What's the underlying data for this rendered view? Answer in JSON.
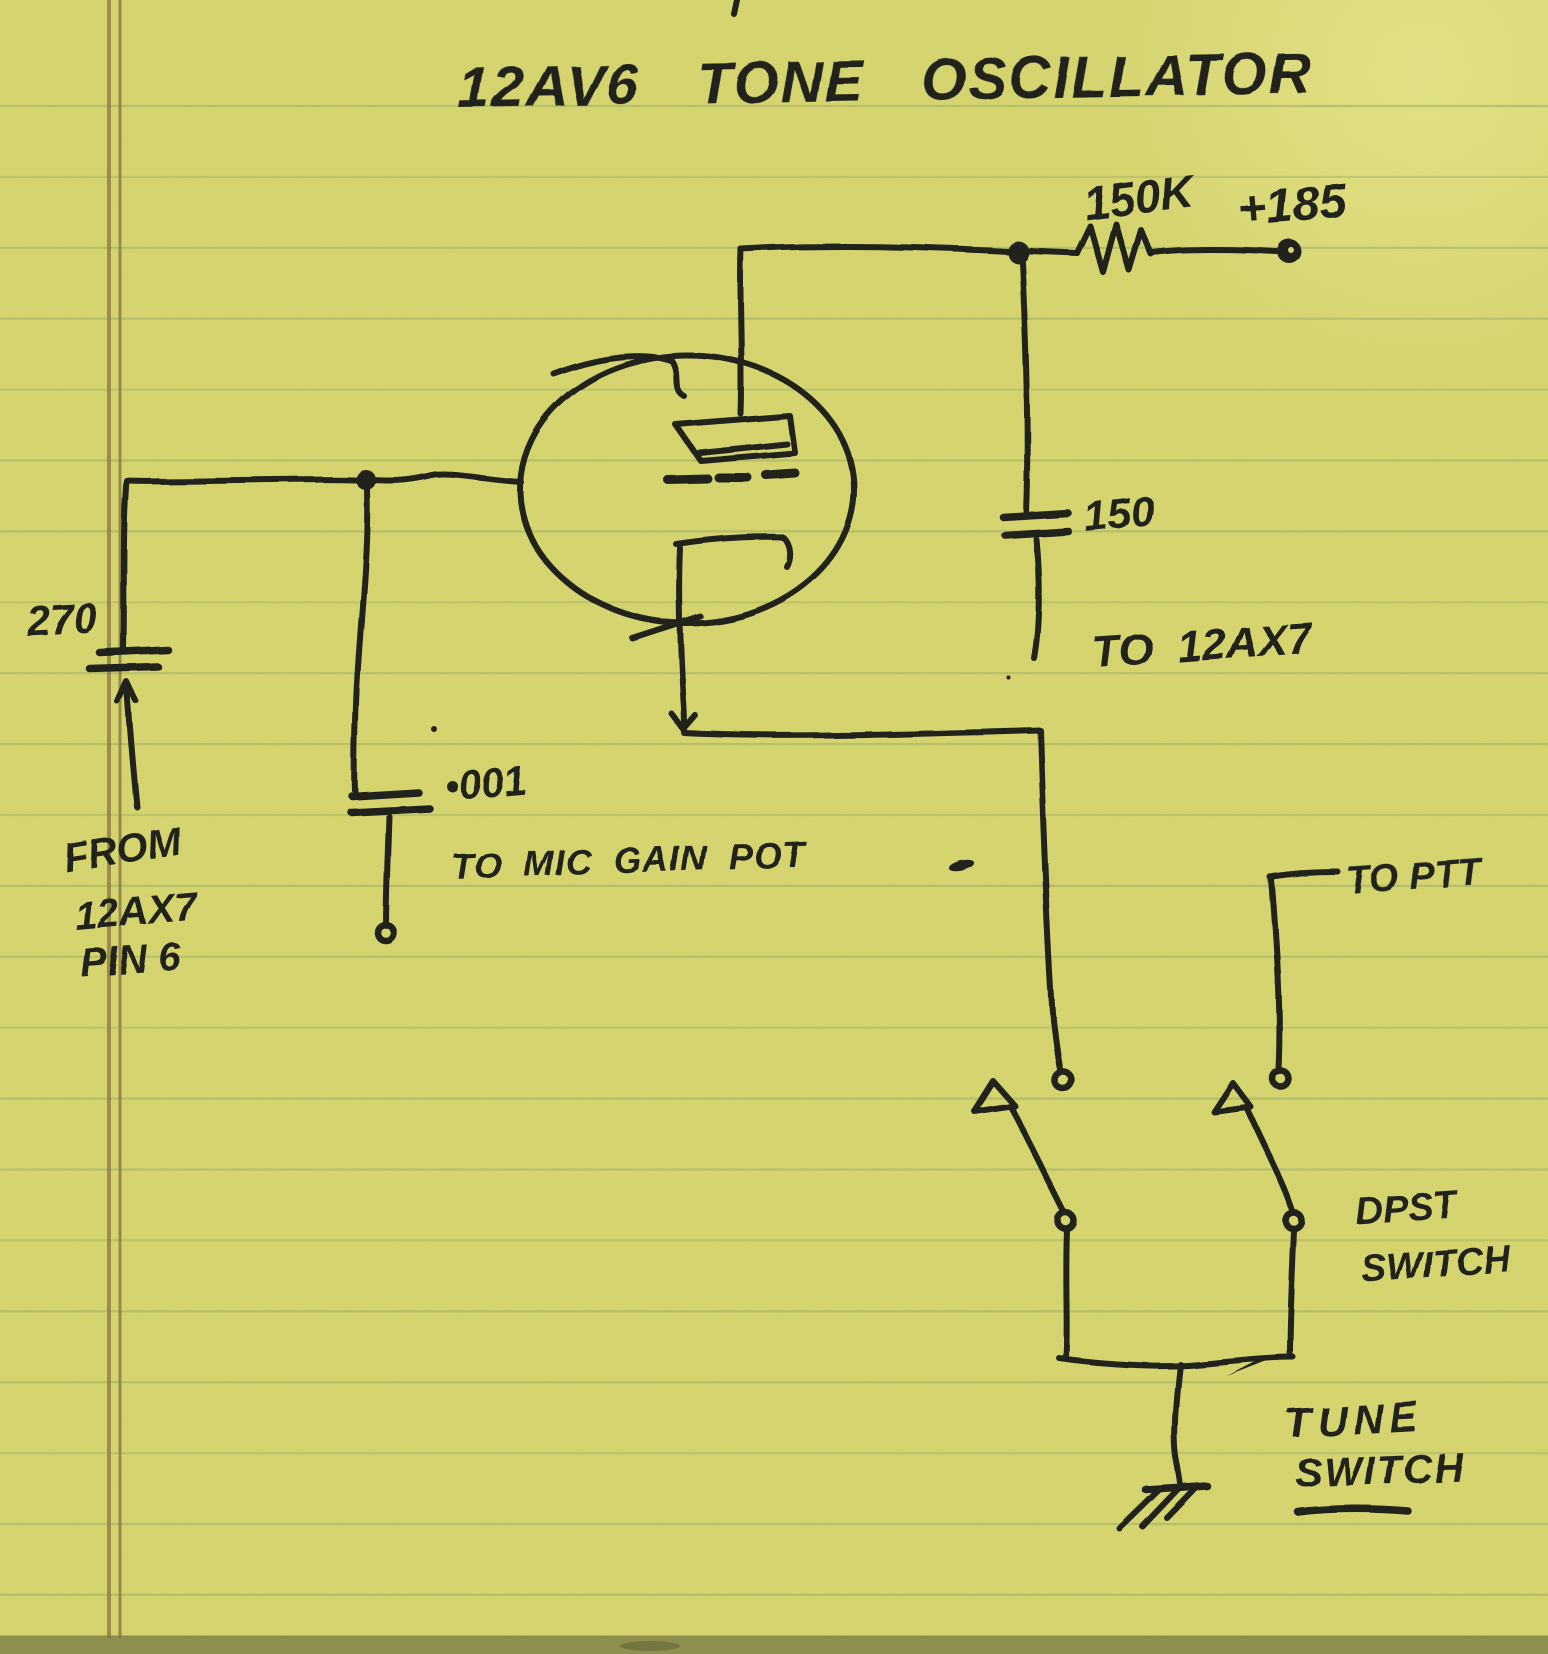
{
  "labels": {
    "title": "12AV6 TONE OSCILLATOR",
    "plate_resistor_value": "150K",
    "supply_voltage": "+185",
    "feedback_cap_value": "150",
    "to_12ax7": "TO 12AX7",
    "grid_cap_value": "270",
    "from_line1": "FROM",
    "from_line2": "12AX7",
    "from_line3": "PIN 6",
    "coupling_cap_value": "•001",
    "to_mic_gain_pot": "TO MIC GAIN POT",
    "to_ptt": "TO PTT",
    "dpst_line1": "DPST",
    "dpst_line2": "SWITCH",
    "tune_line1": "TUNE",
    "tune_line2": "SWITCH"
  },
  "colors": {
    "paper": "#d6d56f",
    "rule_line": "#a6b468",
    "margin_line": "#8d7b44",
    "ink": "#23211b",
    "page_edge": "#8f8f50"
  },
  "ruling": {
    "first_line_y": 106,
    "spacing": 70.9,
    "count": 22
  }
}
